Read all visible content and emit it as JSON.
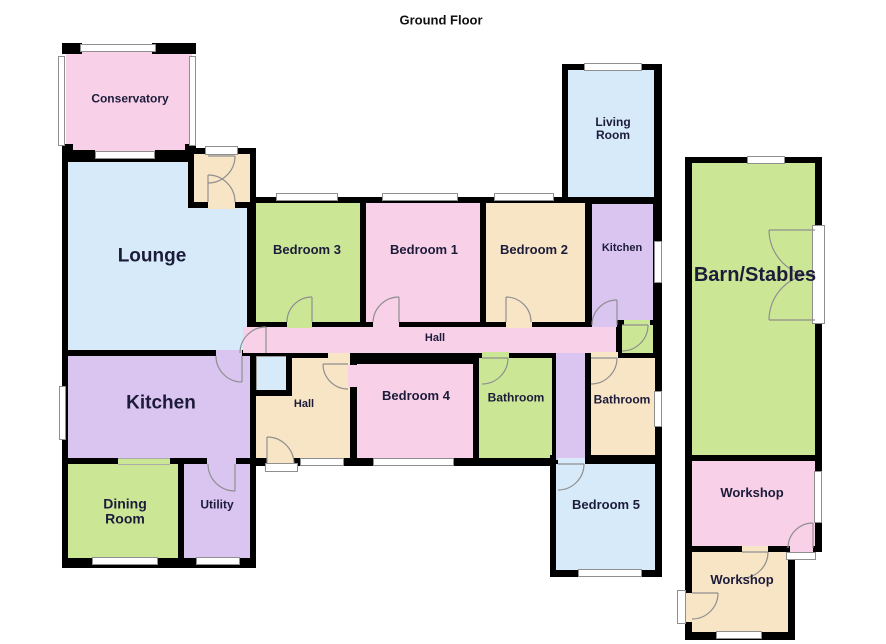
{
  "title": "Ground Floor",
  "palette": {
    "wall": "#000000",
    "pink": "#f8d0e8",
    "blue": "#d6eafa",
    "green": "#cbe795",
    "purple": "#dac4f0",
    "tan": "#f8e5c6",
    "window_fill": "#ffffff",
    "line": "#8f8f8f",
    "label": "#1c1c3a"
  },
  "title_pos": {
    "x": 441,
    "y": 20,
    "size": 13
  },
  "elements": [
    {
      "t": "room",
      "name": "conservatory",
      "c": "pink",
      "r": [
        66,
        47,
        126,
        105
      ],
      "label": "Conservatory",
      "lx": 130,
      "ly": 99,
      "ls": 12
    },
    {
      "t": "wall",
      "name": "conservatory-corner-tl",
      "r": [
        62,
        43,
        20,
        11
      ]
    },
    {
      "t": "wall",
      "name": "conservatory-corner-tr",
      "r": [
        152,
        43,
        44,
        11
      ]
    },
    {
      "t": "wall",
      "name": "conservatory-corner-bl",
      "r": [
        62,
        144,
        11,
        14
      ]
    },
    {
      "t": "wall",
      "name": "conservatory-corner-br",
      "r": [
        185,
        144,
        11,
        14
      ]
    },
    {
      "t": "wall",
      "name": "conservatory-bottom-seg-left",
      "r": [
        62,
        150,
        33,
        11
      ]
    },
    {
      "t": "wall",
      "name": "conservatory-bottom-seg-right",
      "r": [
        155,
        150,
        41,
        11
      ]
    },
    {
      "t": "wall",
      "name": "left-house-block",
      "r": [
        62,
        156,
        194,
        412
      ]
    },
    {
      "t": "room",
      "name": "lounge",
      "c": "blue",
      "r": [
        68,
        162,
        179,
        188
      ],
      "label": "Lounge",
      "lx": 152,
      "ly": 257,
      "ls": 19
    },
    {
      "t": "room",
      "name": "kitchen-left",
      "c": "purple",
      "r": [
        68,
        356,
        182,
        102
      ],
      "label": "Kitchen",
      "lx": 161,
      "ly": 404,
      "ls": 19
    },
    {
      "t": "room",
      "name": "dining-room",
      "c": "green",
      "r": [
        68,
        464,
        110,
        94
      ],
      "label": "Dining\nRoom",
      "lx": 125,
      "ly": 512,
      "ls": 14
    },
    {
      "t": "room",
      "name": "utility",
      "c": "purple",
      "r": [
        184,
        464,
        66,
        94
      ],
      "label": "Utility",
      "lx": 217,
      "ly": 505,
      "ls": 12
    },
    {
      "t": "wall",
      "name": "porch-block",
      "r": [
        188,
        148,
        68,
        60
      ]
    },
    {
      "t": "room",
      "name": "porch",
      "c": "tan",
      "r": [
        194,
        154,
        56,
        48
      ]
    },
    {
      "t": "wall",
      "name": "middle-wing-block",
      "r": [
        250,
        197,
        412,
        269
      ]
    },
    {
      "t": "room",
      "name": "bedroom-3",
      "c": "green",
      "r": [
        256,
        203,
        104,
        119
      ],
      "label": "Bedroom 3",
      "lx": 307,
      "ly": 250,
      "ls": 13
    },
    {
      "t": "room",
      "name": "bedroom-1",
      "c": "pink",
      "r": [
        366,
        203,
        114,
        119
      ],
      "label": "Bedroom 1",
      "lx": 424,
      "ly": 250,
      "ls": 13
    },
    {
      "t": "room",
      "name": "bedroom-2",
      "c": "tan",
      "r": [
        486,
        203,
        99,
        119
      ],
      "label": "Bedroom 2",
      "lx": 534,
      "ly": 250,
      "ls": 13
    },
    {
      "t": "wall",
      "name": "living-wing-block",
      "r": [
        562,
        64,
        100,
        139
      ]
    },
    {
      "t": "room",
      "name": "living-room",
      "c": "blue",
      "r": [
        568,
        70,
        86,
        127
      ],
      "label": "Living\nRoom",
      "lx": 613,
      "ly": 129,
      "ls": 12
    },
    {
      "t": "room",
      "name": "kitchen-right",
      "c": "purple",
      "r": [
        592,
        204,
        61,
        116
      ],
      "label": "Kitchen",
      "lx": 622,
      "ly": 248,
      "ls": 11
    },
    {
      "t": "room",
      "name": "hall-main",
      "c": "pink",
      "r": [
        243,
        327,
        373,
        26
      ],
      "label": "Hall",
      "lx": 435,
      "ly": 338,
      "ls": 11
    },
    {
      "t": "room",
      "name": "rear-lobby",
      "c": "green",
      "r": [
        622,
        325,
        31,
        28
      ]
    },
    {
      "t": "room",
      "name": "hall-lower",
      "c": "tan",
      "r": [
        256,
        358,
        94,
        100
      ],
      "label": "Hall",
      "lx": 304,
      "ly": 404,
      "ls": 11
    },
    {
      "t": "room",
      "name": "cupboard",
      "c": "blue",
      "r": [
        256,
        356,
        30,
        34
      ],
      "cls": "cupboard-line"
    },
    {
      "t": "wall",
      "name": "cupboard-wall-right",
      "r": [
        286,
        356,
        6,
        40
      ]
    },
    {
      "t": "wall",
      "name": "cupboard-wall-bottom",
      "r": [
        256,
        390,
        36,
        6
      ]
    },
    {
      "t": "room",
      "name": "bedroom-4",
      "c": "pink",
      "r": [
        357,
        364,
        116,
        94
      ],
      "label": "Bedroom 4",
      "lx": 416,
      "ly": 396,
      "ls": 13
    },
    {
      "t": "room",
      "name": "bathroom-1",
      "c": "green",
      "r": [
        479,
        358,
        73,
        100
      ],
      "label": "Bathroom",
      "lx": 516,
      "ly": 398,
      "ls": 12
    },
    {
      "t": "room",
      "name": "bathroom-2",
      "c": "tan",
      "r": [
        591,
        358,
        64,
        100
      ],
      "label": "Bathroom",
      "lx": 622,
      "ly": 400,
      "ls": 12
    },
    {
      "t": "wall",
      "name": "bedroom5-block",
      "r": [
        550,
        455,
        112,
        122
      ]
    },
    {
      "t": "room",
      "name": "bedroom-5",
      "c": "blue",
      "r": [
        556,
        464,
        99,
        106
      ],
      "label": "Bedroom 5",
      "lx": 606,
      "ly": 505,
      "ls": 13
    },
    {
      "t": "room",
      "name": "inner-corridor",
      "c": "purple",
      "r": [
        556,
        353,
        29,
        107
      ]
    },
    {
      "t": "wall",
      "name": "barn-block",
      "r": [
        685,
        157,
        137,
        303
      ]
    },
    {
      "t": "wall",
      "name": "workshop1-block",
      "r": [
        685,
        450,
        137,
        102
      ]
    },
    {
      "t": "wall",
      "name": "workshop2-block",
      "r": [
        685,
        545,
        110,
        95
      ]
    },
    {
      "t": "room",
      "name": "barn-stables",
      "c": "green",
      "r": [
        692,
        163,
        123,
        292
      ],
      "label": "Barn/Stables",
      "lx": 755,
      "ly": 275,
      "ls": 20
    },
    {
      "t": "room",
      "name": "workshop-1",
      "c": "pink",
      "r": [
        692,
        461,
        123,
        85
      ],
      "label": "Workshop",
      "lx": 752,
      "ly": 493,
      "ls": 13
    },
    {
      "t": "room",
      "name": "workshop-2",
      "c": "tan",
      "r": [
        692,
        552,
        96,
        80
      ],
      "label": "Workshop",
      "lx": 742,
      "ly": 580,
      "ls": 13
    }
  ],
  "gaps": [
    {
      "r": [
        208,
        150,
        28,
        6
      ],
      "c": "tan",
      "name": "porch-front-doorway"
    },
    {
      "r": [
        208,
        202,
        27,
        7
      ],
      "c": "tan",
      "name": "porch-lounge-doorway"
    },
    {
      "r": [
        216,
        350,
        26,
        7
      ],
      "c": "purple",
      "name": "lounge-kitchen-doorway"
    },
    {
      "r": [
        118,
        458,
        52,
        7
      ],
      "c": "green",
      "cls": "lines",
      "name": "kitchen-dining-opening"
    },
    {
      "r": [
        207,
        458,
        29,
        7
      ],
      "c": "purple",
      "name": "utility-doorway"
    },
    {
      "r": [
        287,
        320,
        25,
        8
      ],
      "c": "green",
      "name": "bedroom3-doorway"
    },
    {
      "r": [
        373,
        320,
        26,
        8
      ],
      "c": "pink",
      "name": "bedroom1-doorway"
    },
    {
      "r": [
        506,
        320,
        26,
        8
      ],
      "c": "tan",
      "name": "bedroom2-doorway"
    },
    {
      "r": [
        328,
        353,
        22,
        12
      ],
      "c": "tan",
      "name": "hall-hall-doorway"
    },
    {
      "r": [
        348,
        365,
        9,
        22
      ],
      "c": "pink",
      "name": "bedroom4-doorway"
    },
    {
      "r": [
        482,
        352,
        27,
        7
      ],
      "c": "green",
      "name": "bathroom1-doorway"
    },
    {
      "r": [
        591,
        352,
        27,
        7
      ],
      "c": "tan",
      "name": "bathroom2-doorway"
    },
    {
      "r": [
        558,
        458,
        27,
        8
      ],
      "c": "blue",
      "name": "bedroom5-doorway"
    },
    {
      "r": [
        592,
        320,
        25,
        7
      ],
      "c": "purple",
      "name": "kitchen-right-doorway"
    },
    {
      "r": [
        624,
        320,
        26,
        6
      ],
      "c": "green",
      "name": "lobby-doorway"
    },
    {
      "r": [
        267,
        458,
        27,
        6
      ],
      "c": "tan",
      "name": "rear-doorway"
    },
    {
      "r": [
        742,
        546,
        26,
        7
      ],
      "c": "tan",
      "name": "workshop-workshop-doorway"
    },
    {
      "r": [
        790,
        546,
        23,
        7
      ],
      "c": "pink",
      "name": "workshop1-ext-doorway"
    },
    {
      "r": [
        685,
        593,
        7,
        29
      ],
      "c": "tan",
      "name": "workshop2-ext-doorway"
    }
  ],
  "windows": [
    {
      "r": [
        80,
        44,
        76,
        8
      ]
    },
    {
      "r": [
        58,
        56,
        7,
        90
      ]
    },
    {
      "r": [
        189,
        56,
        7,
        90
      ]
    },
    {
      "r": [
        95,
        151,
        60,
        8
      ]
    },
    {
      "r": [
        59,
        386,
        7,
        54
      ]
    },
    {
      "r": [
        92,
        557,
        66,
        8
      ]
    },
    {
      "r": [
        196,
        557,
        44,
        8
      ]
    },
    {
      "r": [
        276,
        193,
        62,
        8
      ]
    },
    {
      "r": [
        382,
        193,
        76,
        8
      ]
    },
    {
      "r": [
        494,
        193,
        60,
        8
      ]
    },
    {
      "r": [
        300,
        458,
        44,
        8
      ]
    },
    {
      "r": [
        373,
        458,
        81,
        8
      ]
    },
    {
      "r": [
        654,
        241,
        8,
        42
      ]
    },
    {
      "r": [
        654,
        391,
        8,
        36
      ]
    },
    {
      "r": [
        578,
        569,
        64,
        8
      ]
    },
    {
      "r": [
        584,
        63,
        58,
        8
      ]
    },
    {
      "r": [
        747,
        156,
        38,
        8
      ]
    },
    {
      "r": [
        814,
        471,
        8,
        52
      ]
    },
    {
      "r": [
        716,
        631,
        46,
        8
      ]
    }
  ],
  "ext_doors": [
    {
      "r": [
        205,
        146,
        33,
        9
      ],
      "name": "front-porch-door"
    },
    {
      "r": [
        265,
        463,
        33,
        9
      ],
      "name": "rear-door"
    },
    {
      "r": [
        812,
        225,
        13,
        99
      ],
      "name": "barn-double-door"
    },
    {
      "r": [
        786,
        552,
        30,
        8
      ],
      "name": "workshop1-door"
    },
    {
      "r": [
        677,
        590,
        9,
        34
      ],
      "name": "workshop2-door"
    }
  ],
  "door_swings": [
    {
      "leaf": [
        208,
        156,
        235,
        156
      ],
      "arc": "M235,156 A27,27 0 0 1 208,183"
    },
    {
      "leaf": [
        208,
        202,
        208,
        175
      ],
      "arc": "M208,175 A27,27 0 0 1 235,202"
    },
    {
      "leaf": [
        266,
        353,
        266,
        327
      ],
      "arc": "M266,327 A26,26 0 0 0 240,353"
    },
    {
      "leaf": [
        242,
        356,
        242,
        382
      ],
      "arc": "M216,356 A26,26 0 0 0 242,382"
    },
    {
      "leaf": [
        235,
        464,
        235,
        491
      ],
      "arc": "M208,464 A27,27 0 0 0 235,491"
    },
    {
      "leaf": [
        312,
        322,
        312,
        297
      ],
      "arc": "M312,297 A25,25 0 0 0 287,322"
    },
    {
      "leaf": [
        399,
        322,
        399,
        297
      ],
      "arc": "M399,297 A26,26 0 0 0 373,322"
    },
    {
      "leaf": [
        506,
        322,
        506,
        297
      ],
      "arc": "M506,297 A25,25 0 0 1 531,322"
    },
    {
      "leaf": [
        348,
        364,
        323,
        364
      ],
      "arc": "M323,364 A25,25 0 0 0 348,389"
    },
    {
      "leaf": [
        482,
        358,
        508,
        358
      ],
      "arc": "M508,358 A26,26 0 0 1 482,384"
    },
    {
      "leaf": [
        591,
        358,
        617,
        358
      ],
      "arc": "M617,358 A26,26 0 0 1 591,384"
    },
    {
      "leaf": [
        558,
        464,
        584,
        464
      ],
      "arc": "M584,464 A26,26 0 0 1 558,490"
    },
    {
      "leaf": [
        617,
        325,
        617,
        300
      ],
      "arc": "M617,300 A25,25 0 0 0 592,325"
    },
    {
      "leaf": [
        622,
        325,
        648,
        325
      ],
      "arc": "M648,325 A26,26 0 0 1 622,351"
    },
    {
      "leaf": [
        267,
        464,
        267,
        437
      ],
      "arc": "M267,437 A27,27 0 0 1 294,464"
    },
    {
      "leaf": [
        815,
        230,
        769,
        230
      ],
      "arc": "M769,230 A46,46 0 0 0 815,276"
    },
    {
      "leaf": [
        815,
        320,
        769,
        320
      ],
      "arc": "M769,320 A46,46 0 0 1 815,274"
    },
    {
      "leaf": [
        813,
        548,
        813,
        523
      ],
      "arc": "M813,523 A25,25 0 0 0 788,548"
    },
    {
      "leaf": [
        742,
        552,
        768,
        552
      ],
      "arc": "M768,552 A26,26 0 0 1 742,578"
    },
    {
      "leaf": [
        692,
        593,
        718,
        593
      ],
      "arc": "M718,593 A26,26 0 0 1 692,619"
    }
  ]
}
